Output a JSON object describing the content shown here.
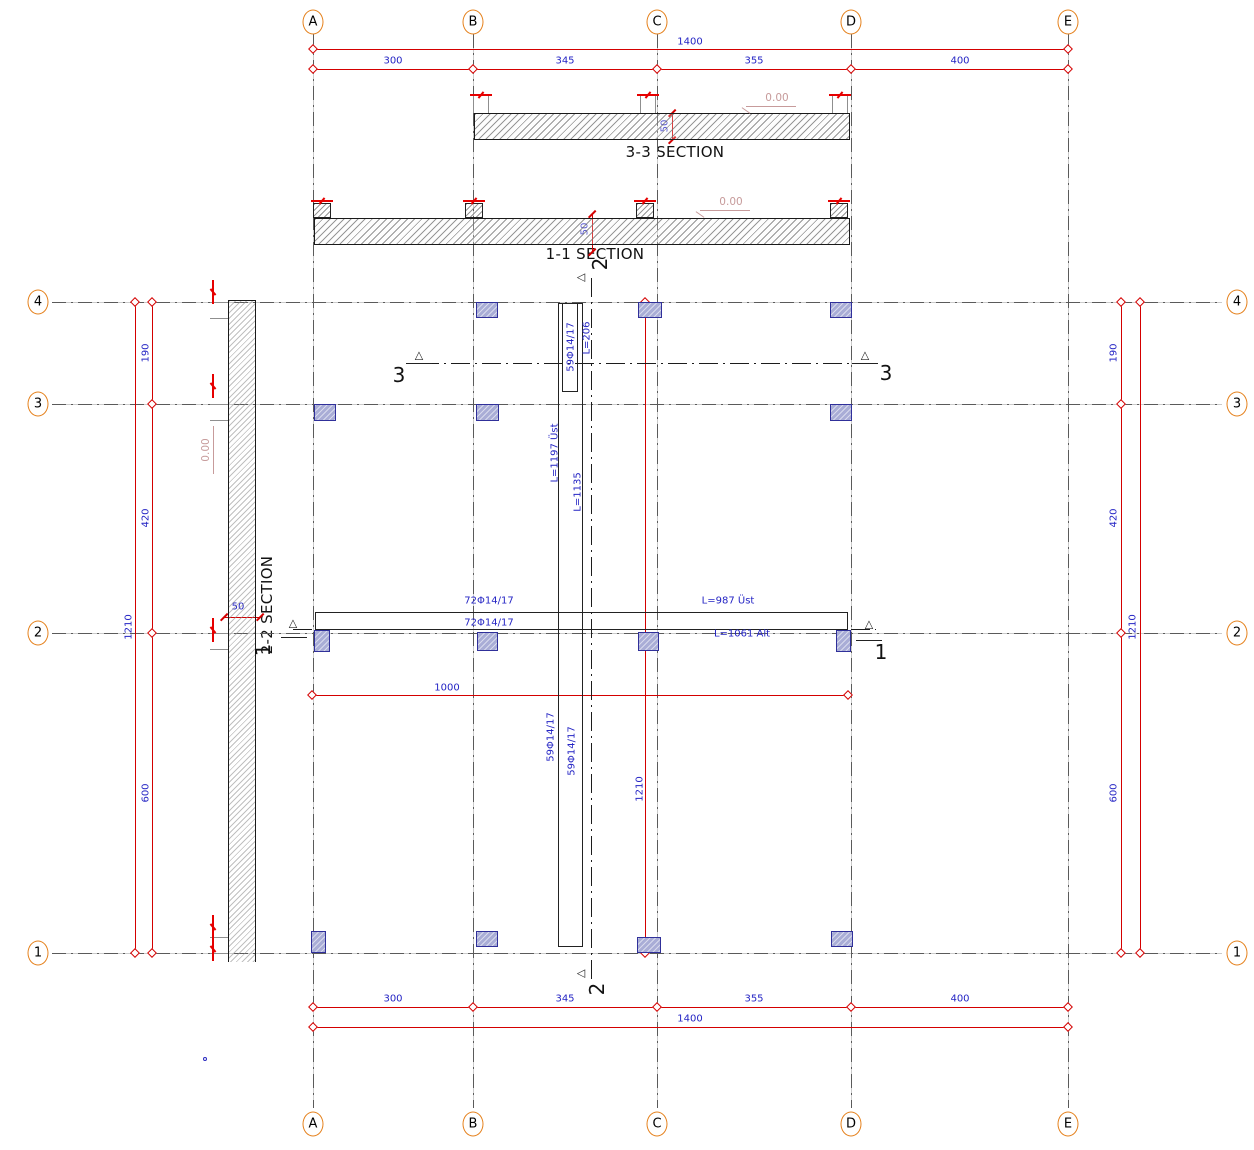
{
  "drawing": {
    "section_titles": {
      "s33": "3-3 SECTION",
      "s11": "1-1 SECTION",
      "s22": "2-2 SECTION"
    },
    "grid": {
      "cols": [
        {
          "label": "A",
          "x": 313
        },
        {
          "label": "B",
          "x": 473
        },
        {
          "label": "C",
          "x": 657
        },
        {
          "label": "D",
          "x": 851
        },
        {
          "label": "E",
          "x": 1068
        }
      ],
      "rows": [
        {
          "label": "4",
          "y": 302
        },
        {
          "label": "3",
          "y": 404
        },
        {
          "label": "2",
          "y": 633
        },
        {
          "label": "1",
          "y": 953
        }
      ],
      "top_bubble_y": 22,
      "bottom_bubble_y": 1124,
      "left_bubble_x": 38,
      "right_bubble_x": 1237
    },
    "dims": {
      "top": {
        "total": "1400",
        "total_y": 49,
        "total_label_y": 42,
        "seg_y": 69,
        "seg_label_y": 61,
        "segments": [
          {
            "text": "300",
            "x": 393
          },
          {
            "text": "345",
            "x": 565
          },
          {
            "text": "355",
            "x": 754
          },
          {
            "text": "400",
            "x": 960
          }
        ],
        "total_label_x": 690
      },
      "bottom": {
        "total": "1400",
        "total_y": 1027,
        "total_label_y": 1019,
        "seg_y": 1007,
        "seg_label_y": 999,
        "segments": [
          {
            "text": "300",
            "x": 393
          },
          {
            "text": "345",
            "x": 565
          },
          {
            "text": "355",
            "x": 754
          },
          {
            "text": "400",
            "x": 960
          }
        ],
        "total_label_x": 690
      },
      "left": {
        "outer_x": 135,
        "inner_x": 152,
        "outer_label": "1210",
        "outer_label_x": 129,
        "outer_label_y": 627,
        "labels": [
          {
            "text": "190",
            "y": 353
          },
          {
            "text": "420",
            "y": 518
          },
          {
            "text": "600",
            "y": 793
          }
        ],
        "label_x": 146
      },
      "right": {
        "outer_x": 1140,
        "inner_x": 1121,
        "outer_label": "1210",
        "outer_label_x": 1133,
        "outer_label_y": 627,
        "labels": [
          {
            "text": "190",
            "y": 353
          },
          {
            "text": "420",
            "y": 518
          },
          {
            "text": "600",
            "y": 793
          }
        ],
        "label_x": 1114
      },
      "plan_h": {
        "text": "1000",
        "y": 695,
        "x1": 312,
        "x2": 848,
        "label_x": 447,
        "label_y": 688
      },
      "plan_v": {
        "text": "1210",
        "x": 645,
        "y1": 302,
        "y2": 953,
        "label_x": 640,
        "label_y": 789
      },
      "small": [
        {
          "text": "50",
          "orient": "v",
          "x": 672,
          "y1": 113,
          "y2": 140,
          "lx": 665,
          "ly": 126
        },
        {
          "text": "50",
          "orient": "v",
          "x": 592,
          "y1": 214,
          "y2": 252,
          "lx": 585,
          "ly": 229
        },
        {
          "text": "50",
          "orient": "h",
          "y": 617,
          "x1": 224,
          "x2": 260,
          "lx": 238,
          "ly": 607
        }
      ]
    },
    "levels": [
      {
        "text": "0.00",
        "cx": 777,
        "cy": 98,
        "rot": 0,
        "ul_x": 746,
        "ul_y": 106,
        "ul_w": 50,
        "hx": 741,
        "hy": 110
      },
      {
        "text": "0.00",
        "cx": 731,
        "cy": 202,
        "rot": 0,
        "ul_x": 700,
        "ul_y": 210,
        "ul_w": 50,
        "hx": 695,
        "hy": 214
      },
      {
        "text": "0.00",
        "cx": 206,
        "cy": 450,
        "rot": -90,
        "ul_x": 213,
        "ul_y": 427,
        "ul_w": 0,
        "hx": 0,
        "hy": 0
      }
    ],
    "section33": {
      "slab": {
        "x": 474,
        "y": 113,
        "w": 376,
        "h": 27
      },
      "stub_centers": [
        481,
        648,
        840
      ],
      "stub_y": 96,
      "stub_h": 17,
      "brk_y": 94,
      "title_cx": 675,
      "title_cy": 152
    },
    "section11": {
      "slab": {
        "x": 314,
        "y": 218,
        "w": 536,
        "h": 27
      },
      "stub_centers": [
        322,
        474,
        645,
        839
      ],
      "stub_y": 203,
      "stub_h": 15,
      "brk_y": 200,
      "title_cx": 595,
      "title_cy": 254
    },
    "section22": {
      "strip": {
        "x": 228,
        "y": 300,
        "w": 28,
        "h": 662
      },
      "stub_rows": [
        302,
        404,
        633,
        937
      ],
      "brk_ys": [
        292,
        386,
        630,
        927,
        949
      ],
      "brk_x": 212,
      "title_cx": 267,
      "title_cy": 605
    },
    "cut_lines": {
      "s3": {
        "y": 363,
        "x1": 420,
        "x2": 868,
        "left": {
          "num": "3",
          "nx": 399,
          "ny": 375,
          "tx": 419,
          "ty": 355,
          "ul_x": 406,
          "ul_y": 363
        },
        "right": {
          "num": "3",
          "nx": 886,
          "ny": 373,
          "tx": 865,
          "ty": 355,
          "ul_x": 852,
          "ul_y": 363
        }
      },
      "s1": {
        "y": 629,
        "x1": 293,
        "x2": 876,
        "left": {
          "num": "1",
          "nx": 263,
          "ny": 650,
          "rot": true,
          "tx": 293,
          "ty": 623,
          "ul_x": 281,
          "ul_y": 637
        },
        "right": {
          "num": "1",
          "nx": 881,
          "ny": 652,
          "rot": false,
          "tx": 869,
          "ty": 624,
          "ul_x": 856,
          "ul_y": 640
        }
      },
      "s2": {
        "x": 591,
        "y1": 278,
        "y2": 980,
        "top": {
          "num": "2",
          "nx": 600,
          "ny": 264,
          "tx": 581,
          "ty": 277
        },
        "bottom": {
          "num": "2",
          "nx": 597,
          "ny": 989,
          "tx": 581,
          "ty": 973
        }
      }
    },
    "rebar": {
      "rect_v1": {
        "x": 558,
        "y": 303,
        "w": 25,
        "h": 644
      },
      "rect_v2": {
        "x": 562,
        "y": 303,
        "w": 16,
        "h": 89
      },
      "rect_h": {
        "x": 315,
        "y": 612,
        "w": 533,
        "h": 18
      },
      "labels_v": [
        {
          "text": "59Φ14/17",
          "cx": 571,
          "cy": 347
        },
        {
          "text": "L=206",
          "cx": 587,
          "cy": 338
        },
        {
          "text": "L=1197 Üst",
          "cx": 555,
          "cy": 453
        },
        {
          "text": "L=1135",
          "cx": 578,
          "cy": 492
        },
        {
          "text": "59Φ14/17",
          "cx": 551,
          "cy": 737
        },
        {
          "text": "59Φ14/17",
          "cx": 572,
          "cy": 751
        }
      ],
      "labels_h": [
        {
          "text": "72Φ14/17",
          "cx": 489,
          "cy": 601
        },
        {
          "text": "L=987 Üst",
          "cx": 728,
          "cy": 601
        },
        {
          "text": "72Φ14/17",
          "cx": 489,
          "cy": 623
        },
        {
          "text": "L=1061 Alt",
          "cx": 742,
          "cy": 634
        }
      ]
    },
    "columns": [
      {
        "x": 476,
        "y": 302,
        "w": 22,
        "h": 16
      },
      {
        "x": 638,
        "y": 302,
        "w": 24,
        "h": 16
      },
      {
        "x": 830,
        "y": 302,
        "w": 22,
        "h": 16
      },
      {
        "x": 314,
        "y": 404,
        "w": 22,
        "h": 17
      },
      {
        "x": 476,
        "y": 404,
        "w": 23,
        "h": 17
      },
      {
        "x": 830,
        "y": 404,
        "w": 22,
        "h": 17
      },
      {
        "x": 314,
        "y": 630,
        "w": 16,
        "h": 22
      },
      {
        "x": 477,
        "y": 632,
        "w": 21,
        "h": 19
      },
      {
        "x": 638,
        "y": 632,
        "w": 21,
        "h": 19
      },
      {
        "x": 836,
        "y": 630,
        "w": 15,
        "h": 22
      },
      {
        "x": 311,
        "y": 931,
        "w": 15,
        "h": 22
      },
      {
        "x": 476,
        "y": 931,
        "w": 22,
        "h": 16
      },
      {
        "x": 637,
        "y": 937,
        "w": 24,
        "h": 16
      },
      {
        "x": 831,
        "y": 931,
        "w": 22,
        "h": 16
      }
    ],
    "artifact_dot": {
      "x": 203,
      "y": 1057
    },
    "colors": {
      "dim_red": "#d40000",
      "text_blue": "#2424c4",
      "level_pink": "#c79b9b",
      "bubble_orange": "#e5821e",
      "column_fill": "#a9add6"
    }
  }
}
